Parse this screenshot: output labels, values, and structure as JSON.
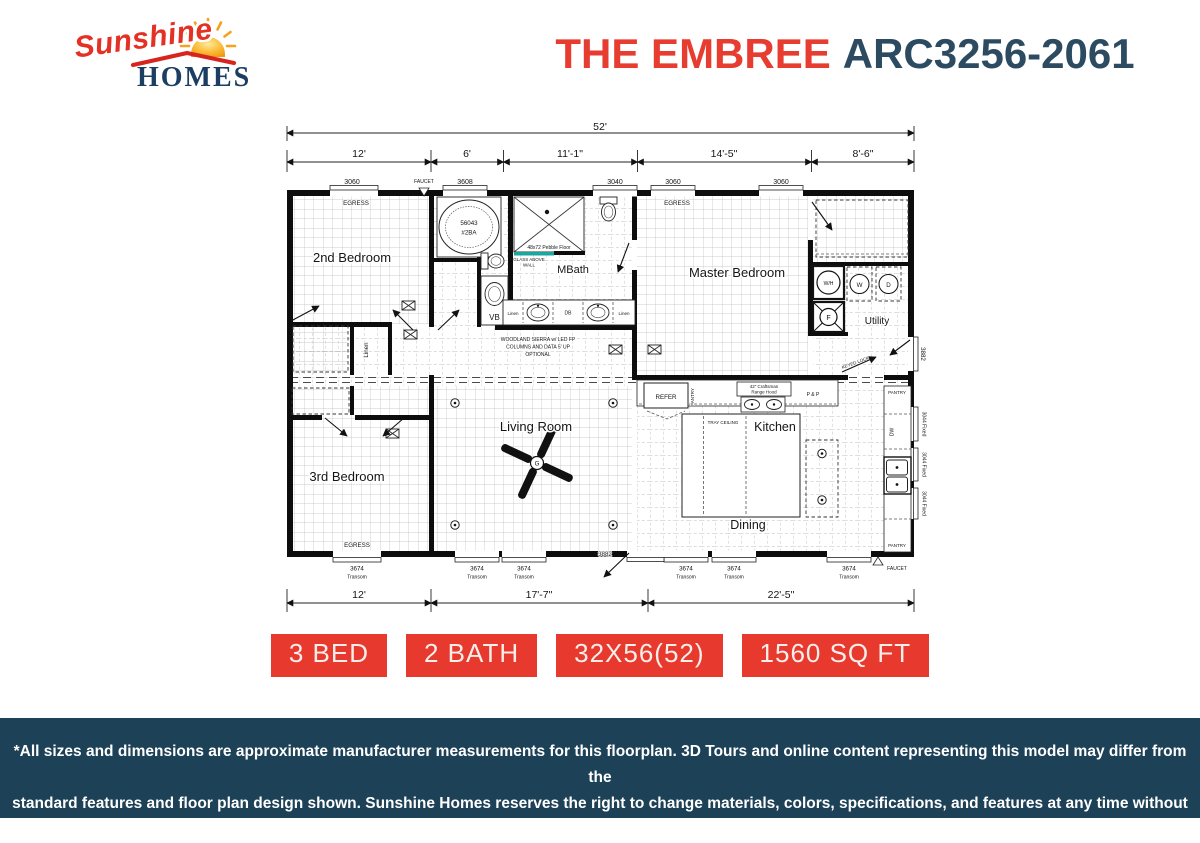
{
  "header": {
    "logo_script": "Sunshine",
    "logo_serif": "HOMES",
    "model_name": "THE EMBREE",
    "model_code": "ARC3256-2061"
  },
  "plan": {
    "dims": {
      "overall_width": "52'",
      "top_segments": [
        "12'",
        "6'",
        "11'-1\"",
        "14'-5\"",
        "8'-6\""
      ],
      "bottom_segments": [
        "12'",
        "17'-7\"",
        "22'-5\""
      ]
    },
    "windows": {
      "top": [
        "3060",
        "3608",
        "3040",
        "3060",
        "3060"
      ],
      "bottom_size": "3674",
      "bottom_type": "Transom",
      "side_fixed": "3044 Fixed",
      "egress": "EGRESS",
      "faucet": "FAUCET"
    },
    "doors": {
      "front": "3882",
      "back": "3882",
      "back_note": "KEYED LOCK"
    },
    "rooms": {
      "bedroom2": "2nd Bedroom",
      "bedroom3": "3rd Bedroom",
      "living": "Living Room",
      "master": "Master Bedroom",
      "mbath": "MBath",
      "kitchen": "Kitchen",
      "dining": "Dining",
      "utility": "Utility",
      "linen": "Linen"
    },
    "fixtures": {
      "tub_model": "56043",
      "tub_tag": "#2BA",
      "shower_floor": "48x72 Pebble Floor",
      "glass_note_1": "GLASS ABOVE",
      "glass_note_2": "WALL",
      "vanity_left": "Linen",
      "vanity_center": "DB",
      "vanity_right": "Linen",
      "vb": "VB",
      "water_heater": "W/H",
      "washer": "W",
      "dryer": "D",
      "furnace": "F",
      "fan": "G",
      "refrigerator": "REFER",
      "pantry": "PANTRY",
      "dishwasher": "DW",
      "range_hood_1": "42\" Craftsman",
      "range_hood_2": "Range Hood",
      "pots_pans": "P & P",
      "tray_ceiling": "TRAY CEILING"
    },
    "notes": {
      "option_1": "WOODLAND SIERRA w/ LED FP",
      "option_2": "COLUMNS AND DATA 5' UP",
      "option_3": "OPTIONAL"
    }
  },
  "badges": [
    {
      "label": "3 BED"
    },
    {
      "label": "2 BATH"
    },
    {
      "label": "32X56(52)"
    },
    {
      "label": "1560 SQ FT"
    }
  ],
  "footer": {
    "line1": "*All sizes and dimensions are approximate manufacturer measurements for this floorplan. 3D Tours and online content representing this model may differ from the",
    "line2": "standard features and floor plan design shown. Sunshine Homes reserves the right to change materials, colors, specifications, and features at any time without notice"
  }
}
